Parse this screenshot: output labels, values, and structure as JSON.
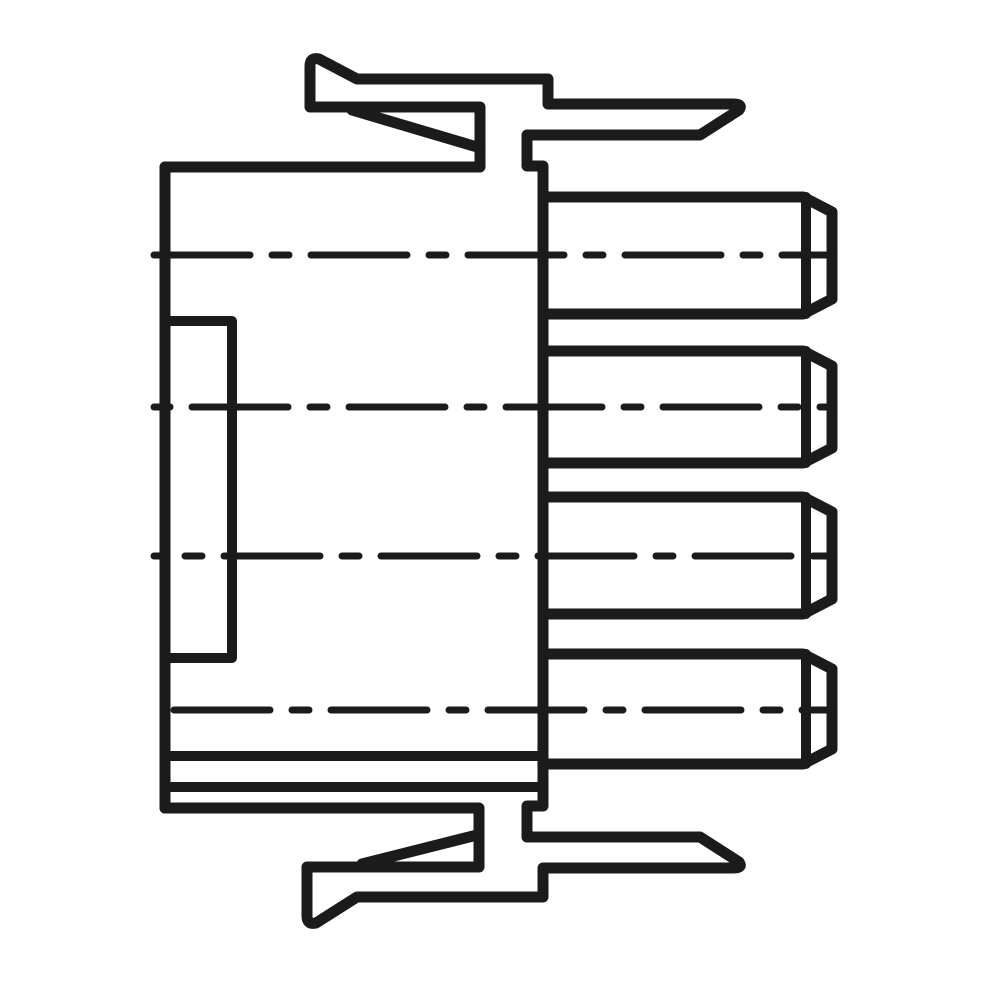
{
  "figure": {
    "description": "Black-and-white technical line drawing: side profile of a 4-pin male connector housing with spring latch arms at top and bottom and four chamfered round pins projecting to the right, each with a dash-dot center axis line.",
    "pin_count": 4
  },
  "colors": {
    "ink": "#1b1b1b",
    "background": "#ffffff"
  },
  "canvas": {
    "width": 1000,
    "height": 1000
  },
  "strokes": {
    "outline": {
      "width": 11
    },
    "detail": {
      "width": 10
    },
    "centerline": {
      "width": 7,
      "dash": "96 22 17 22"
    }
  },
  "paths": [
    {
      "name": "top-latch-outline",
      "role": "outline",
      "d": "M 165 167 L 480 167 L 480 107 L 310 107 L 310 66 Q 310 57 319 59 L 357 79 L 548 79 L 548 104 L 734 104 Q 743 104 739 110 L 700 135 L 527 135 L 527 166 L 543 166 L 543 197"
    },
    {
      "name": "top-latch-barb",
      "role": "outline",
      "d": "M 352 110 L 477 147"
    },
    {
      "name": "bottom-latch-outline",
      "role": "outline",
      "d": "M 165 808 L 479 808 L 479 867 L 307 867 L 307 916 Q 307 925 316 923 L 357 897 L 543 897 L 543 868 L 734 868 Q 743 868 739 862 L 700 837 L 527 837 L 527 806 L 543 806 L 543 765"
    },
    {
      "name": "bottom-latch-barb",
      "role": "outline",
      "d": "M 362 864 L 477 835"
    },
    {
      "name": "body-left-edge",
      "role": "outline",
      "d": "M 165 167 L 165 808"
    },
    {
      "name": "body-right-edge",
      "role": "outline",
      "d": "M 543 197 L 543 765"
    },
    {
      "name": "body-step-notch",
      "role": "detail",
      "d": "M 165 321 L 232 321 L 232 658 L 165 658"
    },
    {
      "name": "flange-line-upper",
      "role": "detail",
      "d": "M 165 756 L 543 756"
    },
    {
      "name": "flange-line-lower",
      "role": "detail",
      "d": "M 165 787 L 543 787"
    },
    {
      "name": "pin-1-outline",
      "role": "outline",
      "d": "M 543 197 L 803 197 L 832 212 L 832 299 L 803 314 L 543 314"
    },
    {
      "name": "pin-1-cap-line",
      "role": "detail",
      "d": "M 806 197 L 806 314"
    },
    {
      "name": "pin-2-outline",
      "role": "outline",
      "d": "M 543 351 L 803 351 L 832 366 L 832 448 L 803 463 L 543 463"
    },
    {
      "name": "pin-2-cap-line",
      "role": "detail",
      "d": "M 806 351 L 806 463"
    },
    {
      "name": "pin-3-outline",
      "role": "outline",
      "d": "M 543 497 L 803 497 L 832 512 L 832 599 L 803 614 L 543 614"
    },
    {
      "name": "pin-3-cap-line",
      "role": "detail",
      "d": "M 806 497 L 806 614"
    },
    {
      "name": "pin-4-outline",
      "role": "outline",
      "d": "M 543 654 L 803 654 L 832 669 L 832 749 L 803 764 L 543 764"
    },
    {
      "name": "pin-4-cap-line",
      "role": "detail",
      "d": "M 806 654 L 806 764"
    },
    {
      "name": "pin-1-centerline",
      "role": "centerline",
      "d": "M 154 255 L 832 255",
      "dashoffset": 0
    },
    {
      "name": "pin-2-centerline",
      "role": "centerline",
      "d": "M 154 407 L 832 407",
      "dashoffset": -38
    },
    {
      "name": "pin-3-centerline",
      "role": "centerline",
      "d": "M 154 556 L 832 556",
      "dashoffset": -70
    },
    {
      "name": "pin-4-centerline",
      "role": "centerline",
      "d": "M 154 710 L 832 710",
      "dashoffset": -20
    }
  ],
  "components": {
    "body": {
      "left": 165,
      "top": 167,
      "right": 543,
      "bottom": 808
    },
    "pins": [
      {
        "label": "pin-1",
        "top": 197,
        "bottom": 314,
        "axis_y": 255,
        "tip_x": 832
      },
      {
        "label": "pin-2",
        "top": 351,
        "bottom": 463,
        "axis_y": 407,
        "tip_x": 832
      },
      {
        "label": "pin-3",
        "top": 497,
        "bottom": 614,
        "axis_y": 556,
        "tip_x": 832
      },
      {
        "label": "pin-4",
        "top": 654,
        "bottom": 764,
        "axis_y": 710,
        "tip_x": 832
      }
    ]
  }
}
